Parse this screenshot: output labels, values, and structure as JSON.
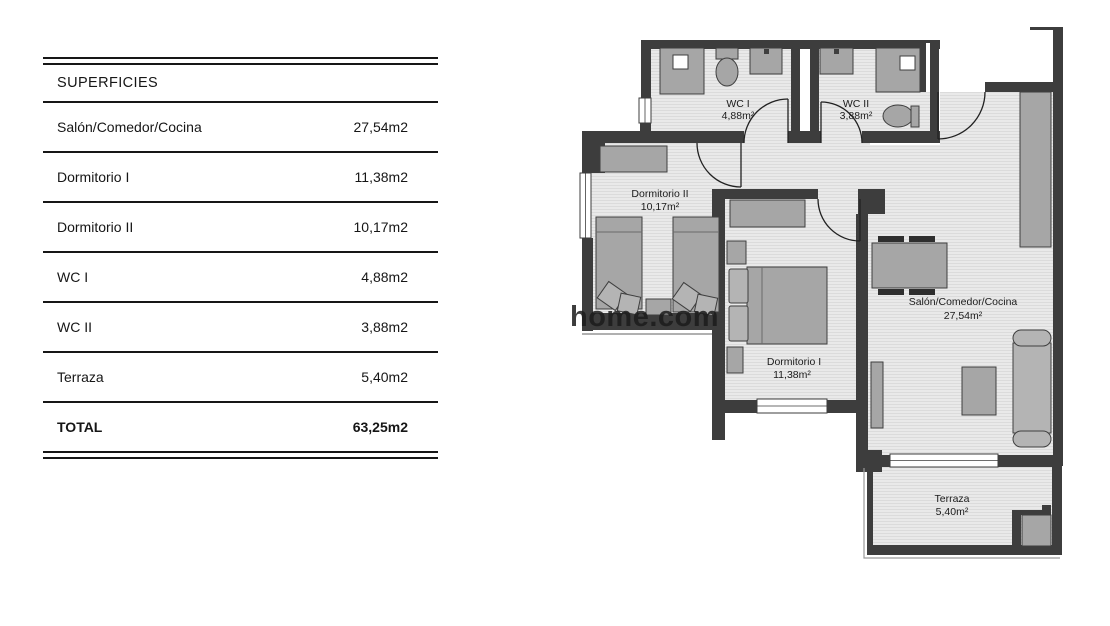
{
  "table": {
    "header": "SUPERFICIES",
    "rows": [
      {
        "label": "Salón/Comedor/Cocina",
        "value": "27,54m2"
      },
      {
        "label": "Dormitorio I",
        "value": "11,38m2"
      },
      {
        "label": "Dormitorio II",
        "value": "10,17m2"
      },
      {
        "label": "WC I",
        "value": "4,88m2"
      },
      {
        "label": "WC II",
        "value": "3,88m2"
      },
      {
        "label": "Terraza",
        "value": "5,40m2"
      }
    ],
    "total": {
      "label": "TOTAL",
      "value": "63,25m2"
    }
  },
  "floorplan": {
    "watermark": "home.com",
    "rooms": [
      {
        "name": "WC I",
        "area": "4,88m²"
      },
      {
        "name": "WC II",
        "area": "3,88m²"
      },
      {
        "name": "Dormitorio II",
        "area": "10,17m²"
      },
      {
        "name": "Dormitorio I",
        "area": "11,38m²"
      },
      {
        "name": "Salón/Comedor/Cocina",
        "area": "27,54m²"
      },
      {
        "name": "Terraza",
        "area": "5,40m²"
      }
    ],
    "colors": {
      "wall": "#3d3d3d",
      "floor": "#e9e9e9",
      "furniture": "#a6a6a6"
    }
  }
}
